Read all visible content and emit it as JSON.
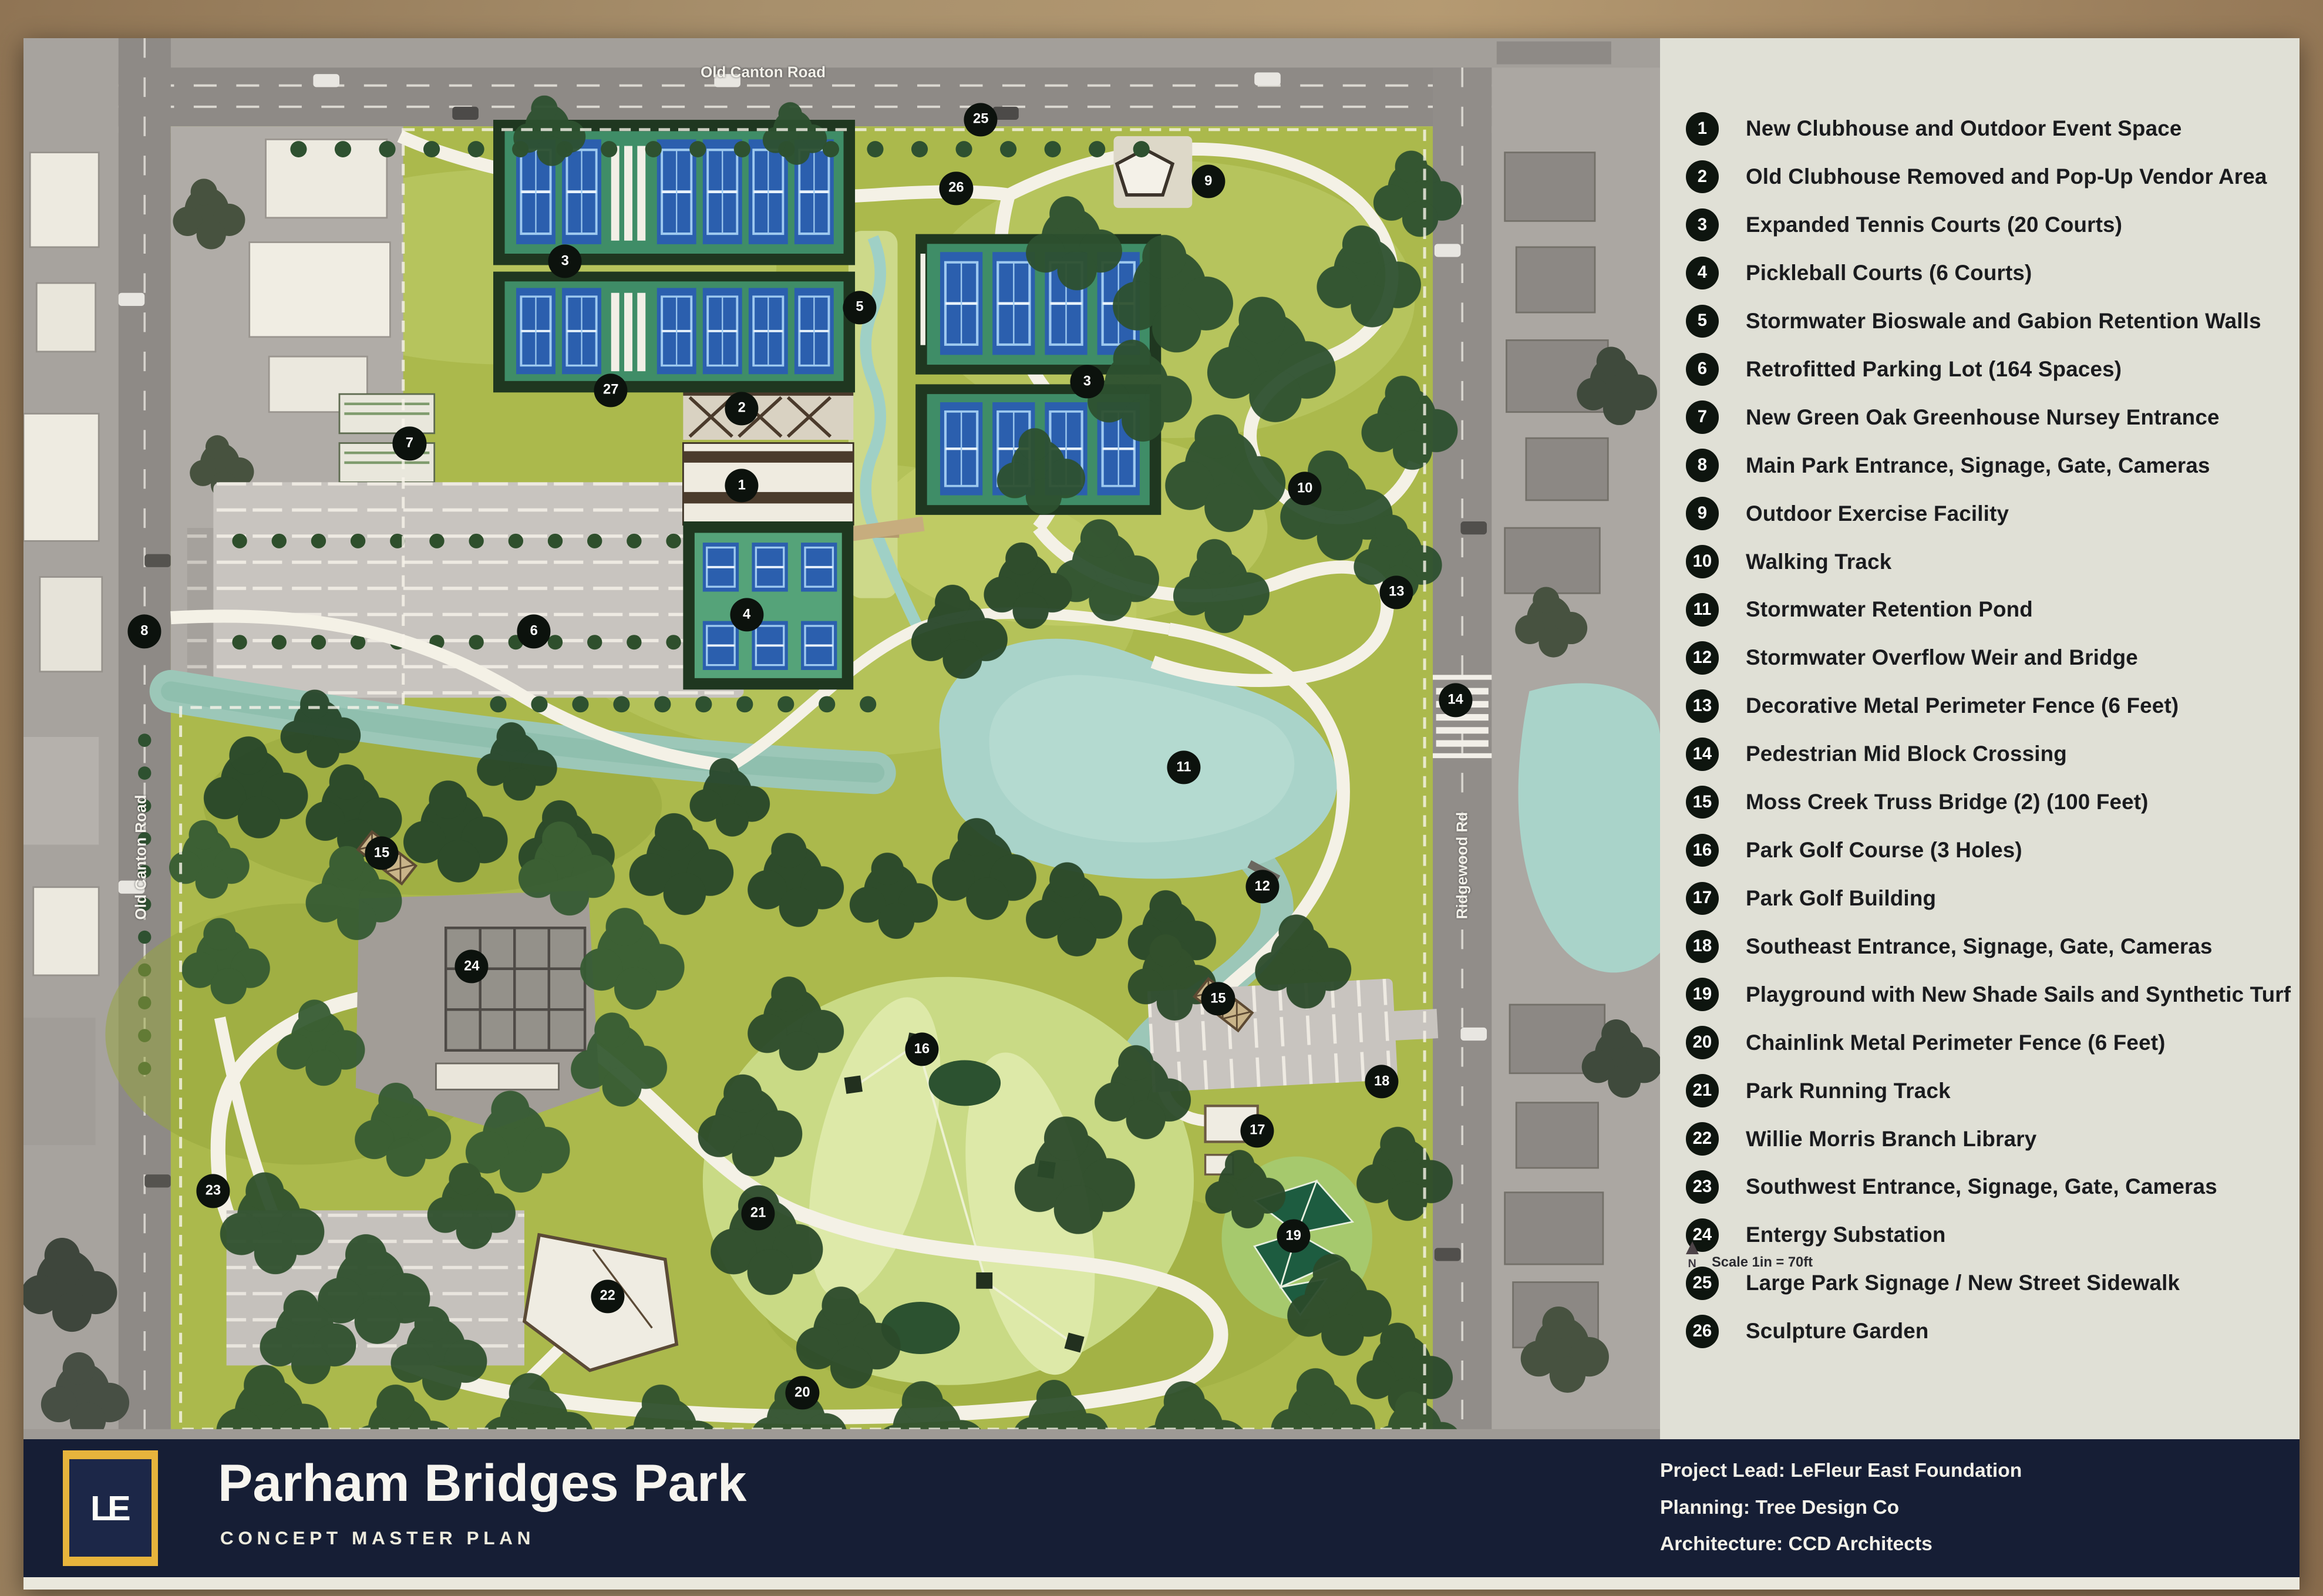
{
  "poster": {
    "title": "Parham Bridges Park",
    "subtitle": "CONCEPT MASTER PLAN",
    "logo_text": "LE",
    "credits": [
      "Project Lead: LeFleur East Foundation",
      "Planning: Tree Design Co",
      "Architecture: CCD Architects"
    ]
  },
  "legend": {
    "north_label": "N",
    "scale_label": "Scale  1in = 70ft",
    "items": [
      {
        "num": "1",
        "label": "New Clubhouse and Outdoor Event Space"
      },
      {
        "num": "2",
        "label": "Old Clubhouse Removed and Pop-Up Vendor Area"
      },
      {
        "num": "3",
        "label": "Expanded Tennis Courts (20 Courts)"
      },
      {
        "num": "4",
        "label": "Pickleball Courts (6 Courts)"
      },
      {
        "num": "5",
        "label": "Stormwater Bioswale and Gabion Retention Walls"
      },
      {
        "num": "6",
        "label": "Retrofitted Parking Lot (164 Spaces)"
      },
      {
        "num": "7",
        "label": "New Green Oak Greenhouse Nursey Entrance"
      },
      {
        "num": "8",
        "label": "Main Park Entrance, Signage, Gate, Cameras"
      },
      {
        "num": "9",
        "label": "Outdoor Exercise Facility"
      },
      {
        "num": "10",
        "label": "Walking Track"
      },
      {
        "num": "11",
        "label": "Stormwater Retention Pond"
      },
      {
        "num": "12",
        "label": "Stormwater Overflow Weir and Bridge"
      },
      {
        "num": "13",
        "label": "Decorative Metal Perimeter Fence  (6 Feet)"
      },
      {
        "num": "14",
        "label": "Pedestrian Mid Block Crossing"
      },
      {
        "num": "15",
        "label": "Moss Creek Truss Bridge (2) (100 Feet)"
      },
      {
        "num": "16",
        "label": "Park Golf Course (3 Holes)"
      },
      {
        "num": "17",
        "label": "Park Golf Building"
      },
      {
        "num": "18",
        "label": "Southeast Entrance, Signage, Gate, Cameras"
      },
      {
        "num": "19",
        "label": "Playground with New Shade Sails and Synthetic Turf"
      },
      {
        "num": "20",
        "label": "Chainlink Metal Perimeter Fence (6 Feet)"
      },
      {
        "num": "21",
        "label": "Park Running Track"
      },
      {
        "num": "22",
        "label": "Willie Morris Branch Library"
      },
      {
        "num": "23",
        "label": "Southwest Entrance, Signage, Gate, Cameras"
      },
      {
        "num": "24",
        "label": "Entergy Substation"
      },
      {
        "num": "25",
        "label": "Large Park Signage / New Street Sidewalk"
      },
      {
        "num": "26",
        "label": "Sculpture Garden"
      }
    ]
  },
  "map": {
    "road_labels": [
      {
        "label": "Old Canton Road",
        "x": 45.2,
        "y": 2.4,
        "rotate": 0
      },
      {
        "label": "Old Canton Road",
        "x": 7.2,
        "y": 58.4,
        "rotate": -90
      },
      {
        "label": "Ridgewood Rd",
        "x": 87.9,
        "y": 59.0,
        "rotate": -90
      }
    ],
    "markers": [
      {
        "num": "1",
        "x": 43.9,
        "y": 31.9
      },
      {
        "num": "2",
        "x": 43.9,
        "y": 26.4
      },
      {
        "num": "3",
        "x": 33.1,
        "y": 15.9
      },
      {
        "num": "3",
        "x": 65.0,
        "y": 24.5
      },
      {
        "num": "4",
        "x": 44.2,
        "y": 41.1
      },
      {
        "num": "5",
        "x": 51.1,
        "y": 19.2
      },
      {
        "num": "6",
        "x": 31.2,
        "y": 42.3
      },
      {
        "num": "7",
        "x": 23.6,
        "y": 28.9
      },
      {
        "num": "8",
        "x": 7.4,
        "y": 42.3
      },
      {
        "num": "9",
        "x": 72.4,
        "y": 10.2
      },
      {
        "num": "10",
        "x": 78.3,
        "y": 32.1
      },
      {
        "num": "11",
        "x": 70.9,
        "y": 52.0
      },
      {
        "num": "12",
        "x": 75.7,
        "y": 60.5
      },
      {
        "num": "13",
        "x": 83.9,
        "y": 39.5
      },
      {
        "num": "14",
        "x": 87.5,
        "y": 47.2
      },
      {
        "num": "15",
        "x": 21.9,
        "y": 58.1
      },
      {
        "num": "15",
        "x": 73.0,
        "y": 68.5
      },
      {
        "num": "16",
        "x": 54.9,
        "y": 72.1
      },
      {
        "num": "17",
        "x": 75.4,
        "y": 77.9
      },
      {
        "num": "18",
        "x": 83.0,
        "y": 74.4
      },
      {
        "num": "19",
        "x": 77.6,
        "y": 85.4
      },
      {
        "num": "20",
        "x": 47.6,
        "y": 96.6
      },
      {
        "num": "21",
        "x": 44.9,
        "y": 83.8
      },
      {
        "num": "22",
        "x": 35.7,
        "y": 89.7
      },
      {
        "num": "23",
        "x": 11.6,
        "y": 82.2
      },
      {
        "num": "24",
        "x": 27.4,
        "y": 66.2
      },
      {
        "num": "25",
        "x": 58.5,
        "y": 5.8
      },
      {
        "num": "26",
        "x": 57.0,
        "y": 10.7
      },
      {
        "num": "27",
        "x": 35.9,
        "y": 25.1
      }
    ]
  },
  "colors": {
    "bar_navy": "#161e35",
    "logo_gold": "#e7b43c",
    "legend_bg": "#e0e0d6",
    "marker_black": "#0c120d",
    "park_green": "#abb94c",
    "pond_teal": "#a9d3c9",
    "court_blue": "#2b5fae",
    "path_cream": "#f4f1e6"
  }
}
